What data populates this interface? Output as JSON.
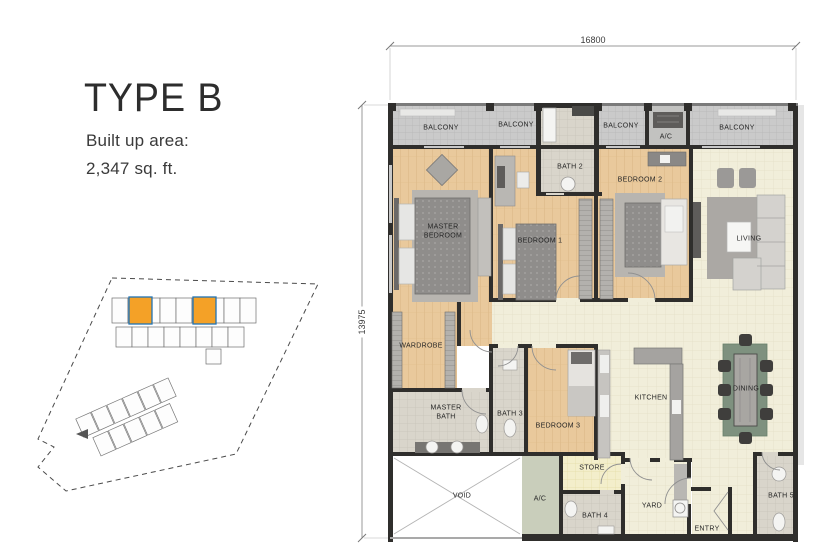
{
  "header": {
    "title": "TYPE B",
    "built_up_label": "Built up area:",
    "built_up_value": "2,347 sq. ft."
  },
  "site_key": {
    "highlight_color": "#F4A127",
    "highlight_border": "#2173B4",
    "boundary_color": "#4A4A4A",
    "unit_outline": "#6E6E6E"
  },
  "plan": {
    "dim_width": "16800",
    "dim_height": "13975",
    "rooms": {
      "balcony_a": "BALCONY",
      "balcony_b": "BALCONY",
      "bath2": "BATH 2",
      "balcony_c": "BALCONY",
      "ac_upper": "A/C",
      "balcony_d": "BALCONY",
      "master_bedroom": "MASTER BEDROOM",
      "bedroom1": "BEDROOM 1",
      "bedroom2": "BEDROOM 2",
      "living": "LIVING",
      "wardrobe": "WARDROBE",
      "master_bath": "MASTER BATH",
      "bath3": "BATH 3",
      "bedroom3": "BEDROOM 3",
      "kitchen": "KITCHEN",
      "dining": "DINING",
      "store": "STORE",
      "ac_lower": "A/C",
      "void": "VOID",
      "bath4": "BATH 4",
      "yard": "YARD",
      "entry": "ENTRY",
      "bath5": "BATH 5"
    },
    "colors": {
      "wall": "#2F2E2C",
      "wood": "#E9C99C",
      "tile_cream": "#F1EEDA",
      "balcony": "#CACACA",
      "bath_tile": "#D9D5CB",
      "store_tile": "#F3EECB",
      "ac_floor": "#C9CEBB",
      "dining_rug": "#7E917F"
    }
  }
}
